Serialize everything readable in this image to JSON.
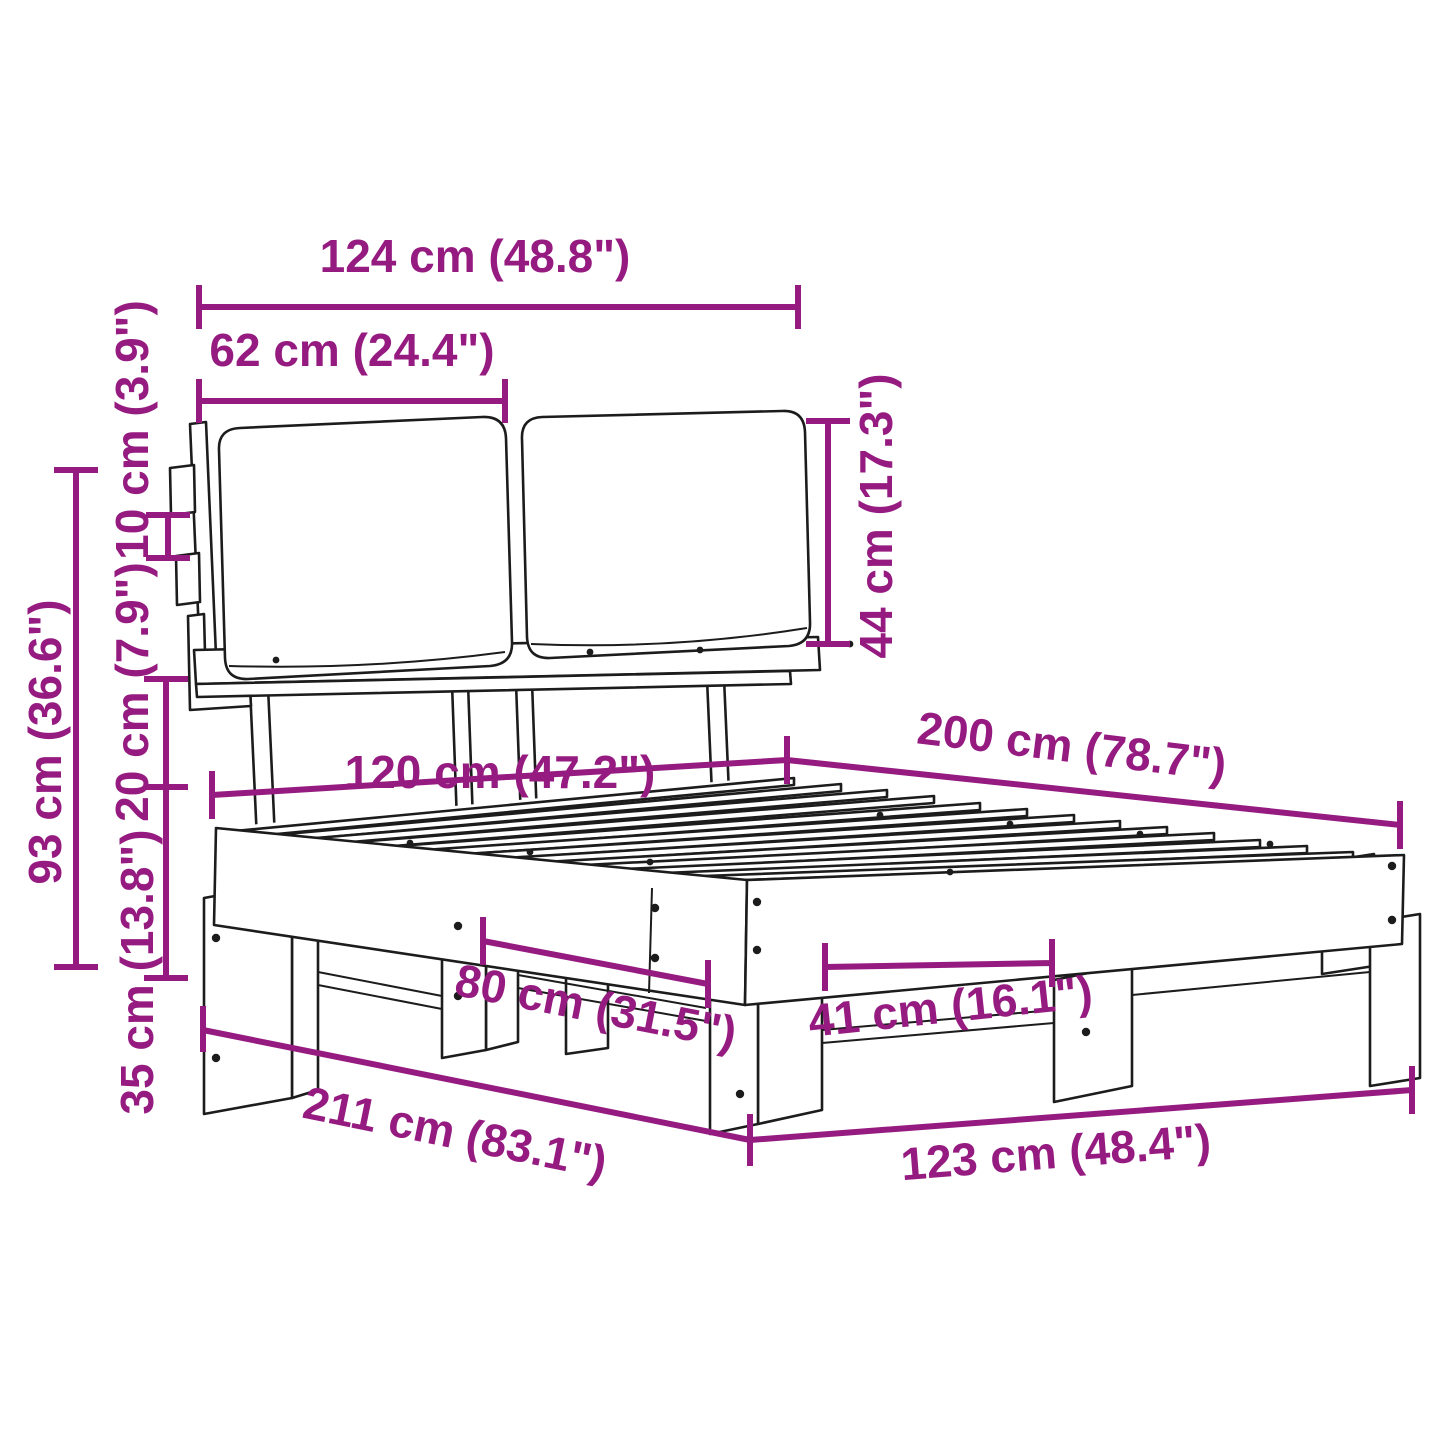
{
  "diagram": {
    "kind": "furniture-dimension-diagram",
    "subject": "bed frame with two cushioned headboard pads, slatted base and block legs",
    "accent_color": "#951b81",
    "line_color": "#1c1c1c",
    "background_color": "#ffffff"
  },
  "dims": {
    "d124": {
      "cm": 124,
      "in": 48.8,
      "label": "124 cm (48.8\")"
    },
    "d62": {
      "cm": 62,
      "in": 24.4,
      "label": "62 cm (24.4\")"
    },
    "d10": {
      "cm": 10,
      "in": 3.9,
      "label": "10 cm (3.9\")"
    },
    "d20": {
      "cm": 20,
      "in": 7.9,
      "label": "20 cm (7.9\")"
    },
    "d35": {
      "cm": 35,
      "in": 13.8,
      "label": "35 cm (13.8\")"
    },
    "d93": {
      "cm": 93,
      "in": 36.6,
      "label": "93 cm (36.6\")"
    },
    "d44": {
      "cm": 44,
      "in": 17.3,
      "label": "44 cm (17.3\")"
    },
    "d120": {
      "cm": 120,
      "in": 47.2,
      "label": "120 cm (47.2\")"
    },
    "d200": {
      "cm": 200,
      "in": 78.7,
      "label": "200 cm (78.7\")"
    },
    "d80": {
      "cm": 80,
      "in": 31.5,
      "label": "80 cm (31.5\")"
    },
    "d41": {
      "cm": 41,
      "in": 16.1,
      "label": "41 cm (16.1\")"
    },
    "d211": {
      "cm": 211,
      "in": 83.1,
      "label": "211 cm (83.1\")"
    },
    "d123": {
      "cm": 123,
      "in": 48.4,
      "label": "123 cm (48.4\")"
    }
  }
}
